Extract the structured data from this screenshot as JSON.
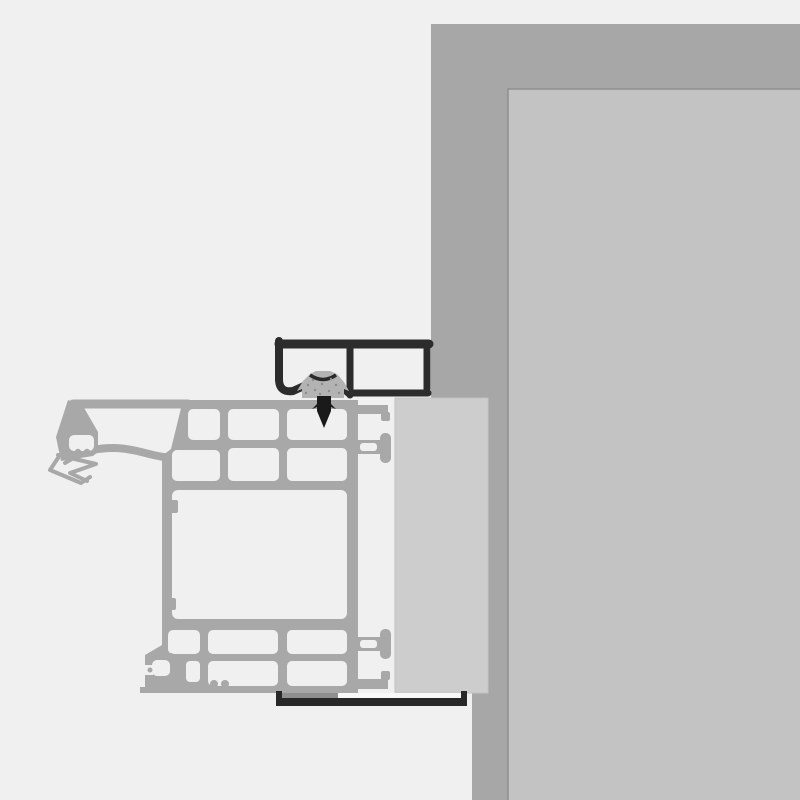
{
  "meta": {
    "title": "Window frame installation cross-section detail",
    "description": "Technical section drawing of a multi-chamber frame profile fixed to a wall reveal with a top mounting bracket, fixing clip and screw, a bottom mounting rail, and an infill panel. No text labels are present in the image.",
    "text_content": "none"
  },
  "colors": {
    "background": "#f0f0f0",
    "wall_outer": "#a7a7a7",
    "wall_inner": "#c3c3c3",
    "wall_edge": "#8f8f8f",
    "panel": "#cdcdcd",
    "panel_edge": "#c2c2c2",
    "profile": "#a8a8a8",
    "chamber": "#f0f0f0",
    "bracket_dark": "#2c2c2c",
    "clip": "#b3b3b3",
    "clip_dot": "#8c8c8c",
    "clip_arc": "#2a2a2a",
    "screw": "#1a1a1a",
    "rail_dark": "#282828",
    "rail_gray": "#8f8f8f",
    "rail_light": "#f8f8f8"
  },
  "components": {
    "wall": "masonry wall with inner reveal surface",
    "panel": "infill / backing panel between frame and wall",
    "frame_profile": "multi-chamber extruded frame profile with gasket nose",
    "gasket": "flexible sealing gasket at the outer nose",
    "top_bracket": "dark installation bracket with two bays",
    "clip": "stippled fixing clip seated in bracket",
    "screw": "self-tapping fixing screw driven into profile",
    "bottom_rail": "dark bottom mounting rail channel",
    "connectors": "T-shaped push connectors and retention arms holding the panel"
  }
}
